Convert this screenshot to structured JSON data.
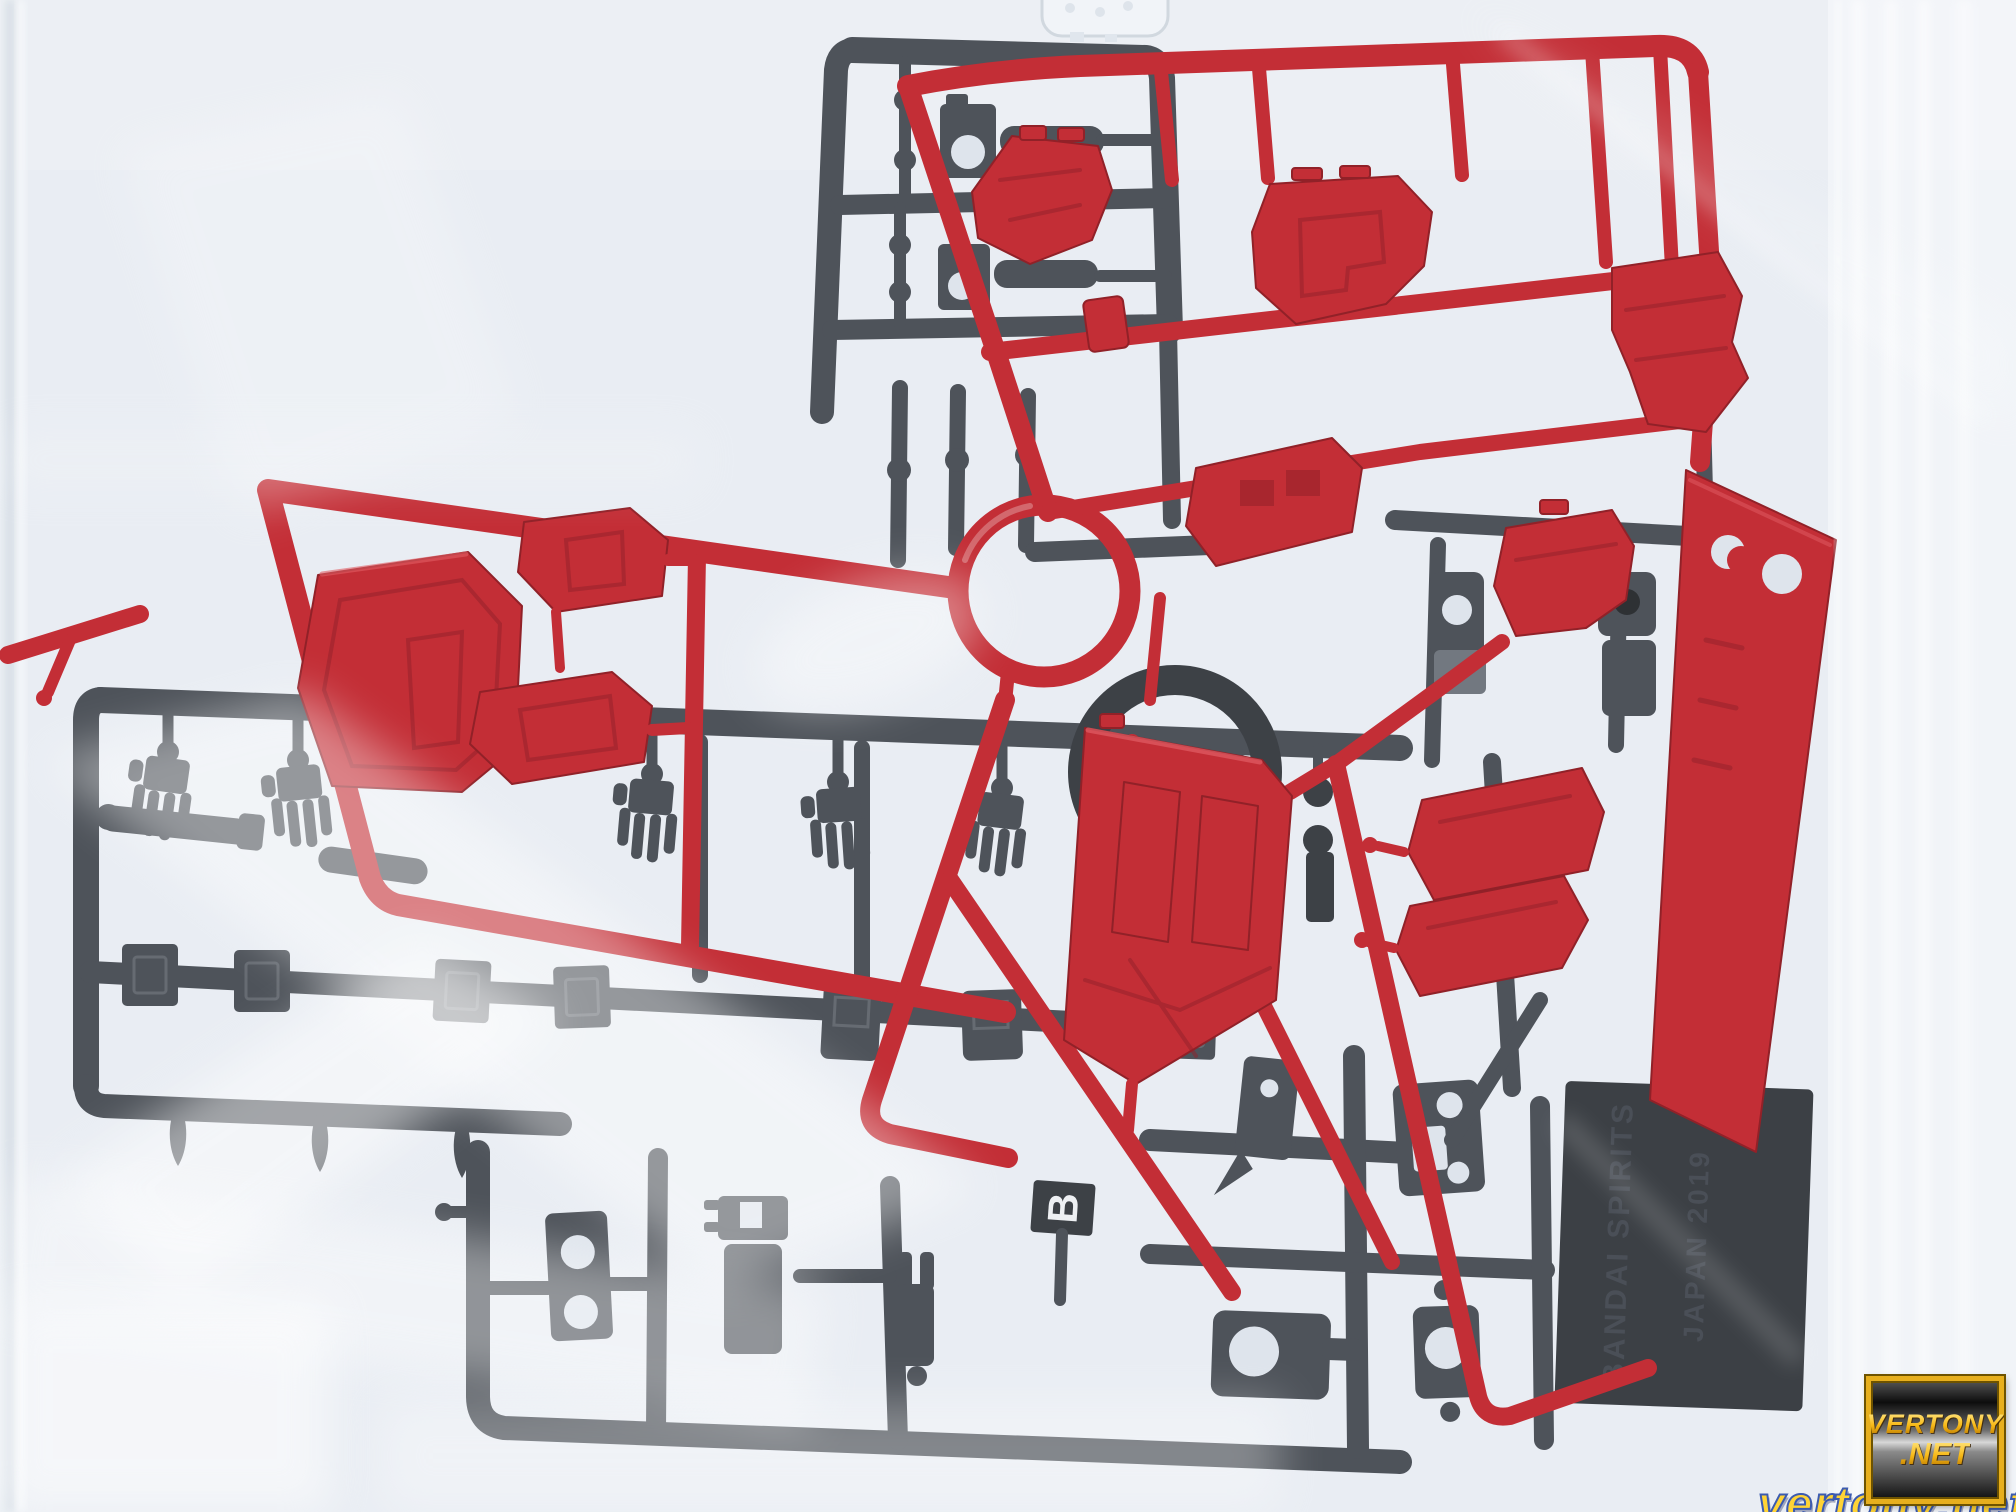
{
  "texts": {
    "runner_letter": "B",
    "tag_line1": "BANDAI SPIRITS",
    "tag_line2": "JAPAN 2019",
    "watermark_line1": "VERTONY",
    "watermark_line2": ".NET",
    "watermark_url": "vertony.net"
  },
  "colors": {
    "bag_bg": "#e8edf3",
    "bag_bright": "#f8fafc",
    "red": "#c0232c",
    "red_dark": "#8c161d",
    "red_light": "#e0555c",
    "gray": "#454a52",
    "gray_dark": "#33373d",
    "gray_light": "#6b717a",
    "hole": "#dde3eb",
    "tag_plate": "#32363c",
    "tag_text": "#41464e",
    "letter_color": "#eef0f3",
    "clear_part": "#f1f4f8",
    "wm_frame": "#e7af1e",
    "wm_text": "#f6c31c",
    "wm_url": "#ffd335",
    "wm_url_outline": "#3c5bb0"
  }
}
